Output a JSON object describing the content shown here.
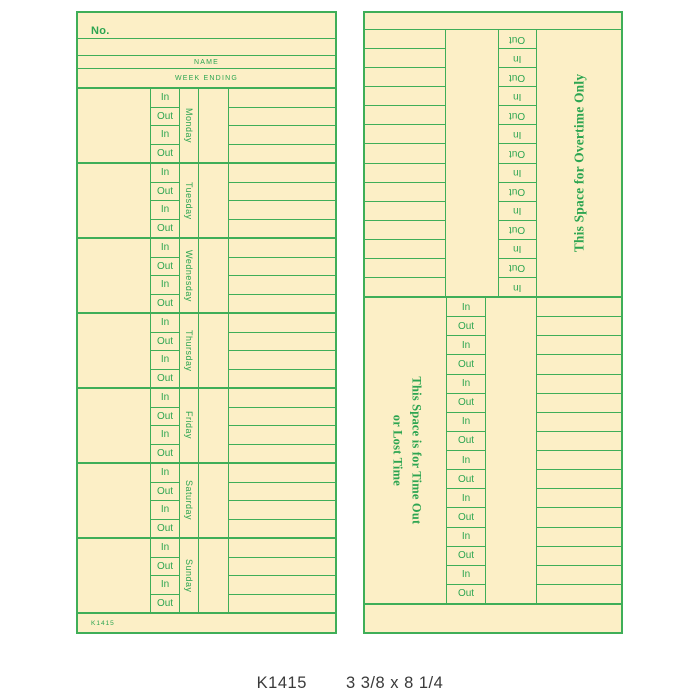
{
  "caption": {
    "sku": "K1415",
    "dimensions": "3 3/8 x 8 1/4"
  },
  "colors": {
    "card_bg": "#fcefc6",
    "line_green": "#3fae58",
    "text_green": "#2da551",
    "caption_text": "#3a3a3a"
  },
  "front_card": {
    "no_label": "No.",
    "name_label": "NAME",
    "week_ending_label": "WEEK ENDING",
    "days": [
      "Monday",
      "Tuesday",
      "Wednesday",
      "Thursday",
      "Friday",
      "Saturday",
      "Sunday"
    ],
    "punch_labels": [
      "In",
      "Out",
      "In",
      "Out"
    ],
    "footer_code": "K1415"
  },
  "back_card": {
    "overtime_section": {
      "title": "This Space for Overtime Only",
      "rows": [
        "Out",
        "In",
        "Out",
        "In",
        "Out",
        "In",
        "Out",
        "In",
        "Out",
        "In",
        "Out",
        "In",
        "Out",
        "In"
      ]
    },
    "timeout_section": {
      "title_line1": "This Space is for Time Out",
      "title_line2": "or Lost Time",
      "rows": [
        "In",
        "Out",
        "In",
        "Out",
        "In",
        "Out",
        "In",
        "Out",
        "In",
        "Out",
        "In",
        "Out",
        "In",
        "Out",
        "In",
        "Out"
      ]
    }
  }
}
